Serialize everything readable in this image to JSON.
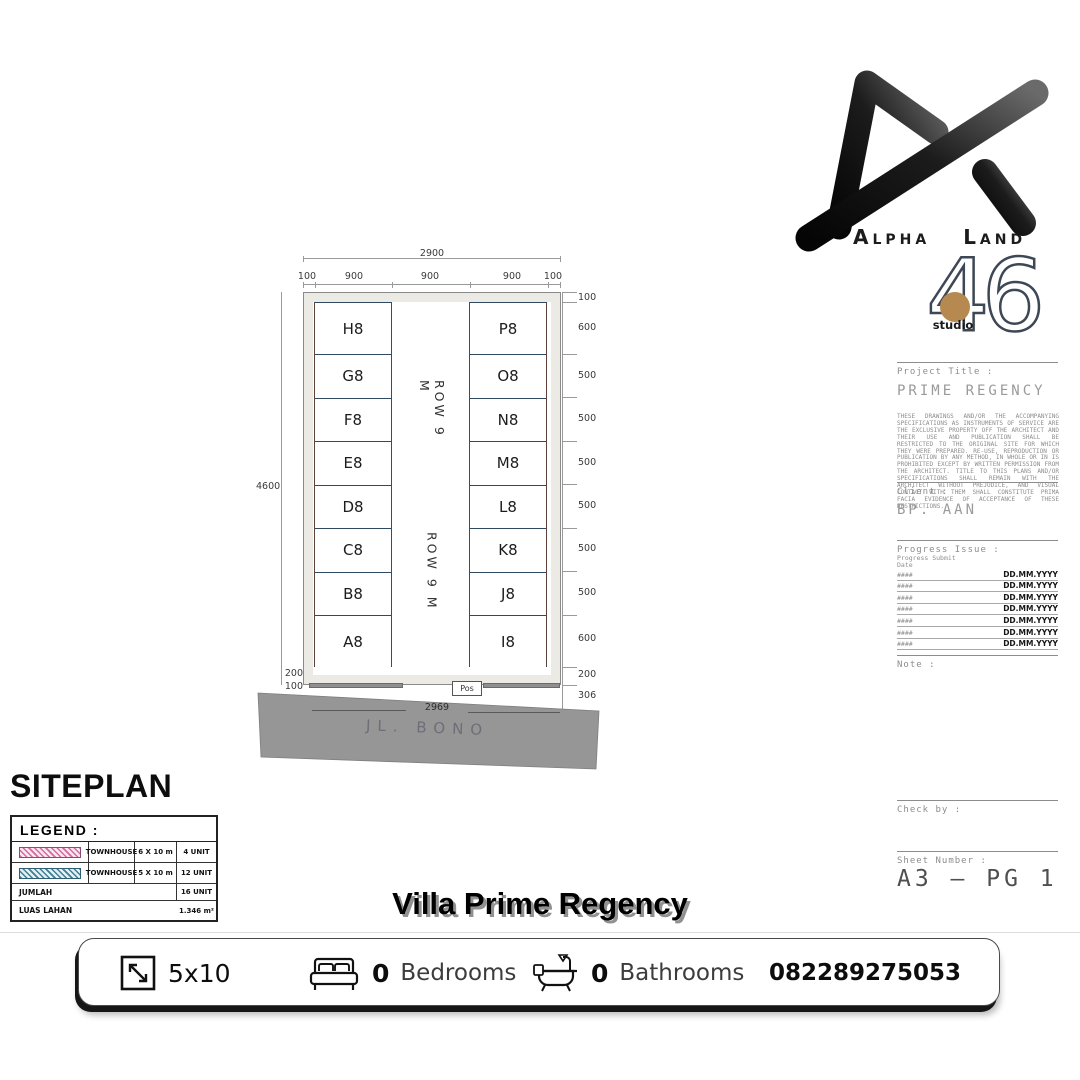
{
  "brand": {
    "wordmark_left": "Alpha",
    "wordmark_right": "Land",
    "studio_number": "46",
    "studio_label": "studio",
    "accent_dot_color": "#b5894f"
  },
  "plan": {
    "left_lots": [
      "H8",
      "G8",
      "F8",
      "E8",
      "D8",
      "C8",
      "B8",
      "A8"
    ],
    "right_lots": [
      "P8",
      "O8",
      "N8",
      "M8",
      "L8",
      "K8",
      "J8",
      "I8"
    ],
    "row_label": "ROW 9 M",
    "pos_label": "Pos",
    "street_label": "JL. BONO",
    "dims": {
      "top_total": "2900",
      "top_segments": [
        "100",
        "900",
        "900",
        "900",
        "100"
      ],
      "left_total": "4600",
      "left_bottom": [
        "200",
        "100"
      ],
      "right": [
        "100",
        "600",
        "500",
        "500",
        "500",
        "500",
        "500",
        "500",
        "600",
        "200",
        "306"
      ],
      "bottom_total": "2969"
    }
  },
  "siteplan_heading": "SITEPLAN",
  "legend": {
    "title": "LEGEND :",
    "rows": [
      {
        "type": "TOWNHOUSE",
        "size": "6 X 10 m",
        "units": "4 UNIT"
      },
      {
        "type": "TOWNHOUSE",
        "size": "5 X 10 m",
        "units": "12 UNIT"
      }
    ],
    "total_label": "JUMLAH",
    "total_value": "16 UNIT",
    "area_label": "LUAS LAHAN",
    "area_value": "1.346 m²"
  },
  "title_block": {
    "project_title_label": "Project Title :",
    "project_title": "PRIME REGENCY",
    "disclaimer": "THESE DRAWINGS AND/OR THE ACCOMPANYING SPECIFICATIONS AS INSTRUMENTS OF SERVICE ARE THE EXCLUSIVE PROPERTY OFF THE ARCHITECT AND THEIR USE AND PUBLICATION SHALL BE RESTRICTED TO THE ORIGINAL SITE FOR WHICH THEY WERE PREPARED. RE-USE, REPRODUCTION OR PUBLICATION BY ANY METHOD, IN WHOLE OR IN IS PROHIBITED EXCEPT BY WRITTEN PERMISSION FROM THE ARCHITECT. TITLE TO THIS PLANS AND/OR SPECIFICATIONS SHALL REMAIN WITH THE ARCHITECT WITHOUT PREJUDICE, AND VISUAL CONTACT WITH THEM SHALL CONSTITUTE PRIMA FACIA EVIDENCE OF ACCEPTANCE OF THESE RESTRICTIONS.",
    "client_label": "Client :",
    "client": "BP. AAN",
    "progress_label": "Progress Issue :",
    "submit_header": "Progress Submit",
    "date_header": "Date",
    "rows": [
      {
        "no": "####",
        "date": "DD.MM.YYYY"
      },
      {
        "no": "####",
        "date": "DD.MM.YYYY"
      },
      {
        "no": "####",
        "date": "DD.MM.YYYY"
      },
      {
        "no": "####",
        "date": "DD.MM.YYYY"
      },
      {
        "no": "####",
        "date": "DD.MM.YYYY"
      },
      {
        "no": "####",
        "date": "DD.MM.YYYY"
      },
      {
        "no": "####",
        "date": "DD.MM.YYYY"
      }
    ],
    "note_label": "Note :",
    "check_label": "Check by :",
    "sheet_label": "Sheet Number :",
    "sheet_number": "A3 — PG 1"
  },
  "property_bar": {
    "title": "Villa Prime Regency",
    "size": "5x10",
    "bedrooms_count": "0",
    "bedrooms_label": "Bedrooms",
    "bathrooms_count": "0",
    "bathrooms_label": "Bathrooms",
    "phone": "082289275053"
  }
}
